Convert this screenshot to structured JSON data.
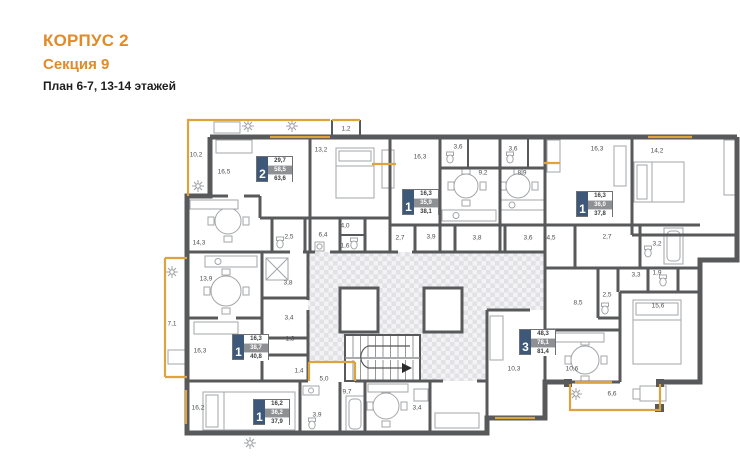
{
  "header": {
    "building": "КОРПУС 2",
    "section": "Секция 9",
    "plan": "План 6-7, 13-14 этажей"
  },
  "colors": {
    "accent_orange": "#E18B28",
    "card_number_bg": "#3D5878",
    "card_mid_bg": "#8E9093",
    "wall_gray": "#58595B",
    "window_orange": "#DDA43E"
  },
  "apartments": [
    {
      "rooms": "2",
      "living_area": "29,7",
      "area_no_balcony": "58,5",
      "total_area": "63,6"
    },
    {
      "rooms": "1",
      "living_area": "16,3",
      "area_no_balcony": "35,9",
      "total_area": "38,1"
    },
    {
      "rooms": "1",
      "living_area": "16,3",
      "area_no_balcony": "36,0",
      "total_area": "37,8"
    },
    {
      "rooms": "1",
      "living_area": "16,3",
      "area_no_balcony": "38,7",
      "total_area": "40,8"
    },
    {
      "rooms": "1",
      "living_area": "16,2",
      "area_no_balcony": "36,2",
      "total_area": "37,9"
    },
    {
      "rooms": "3",
      "living_area": "48,3",
      "area_no_balcony": "78,1",
      "total_area": "81,4"
    }
  ],
  "room_labels": [
    {
      "t": "10,2",
      "x": 196,
      "y": 155
    },
    {
      "t": "16,5",
      "x": 224,
      "y": 172
    },
    {
      "t": "13,2",
      "x": 321,
      "y": 150
    },
    {
      "t": "1,2",
      "x": 346,
      "y": 129
    },
    {
      "t": "16,3",
      "x": 420,
      "y": 157
    },
    {
      "t": "3,6",
      "x": 458,
      "y": 147
    },
    {
      "t": "3,6",
      "x": 513,
      "y": 149
    },
    {
      "t": "9,2",
      "x": 483,
      "y": 173
    },
    {
      "t": "8,9",
      "x": 522,
      "y": 173
    },
    {
      "t": "16,3",
      "x": 597,
      "y": 149
    },
    {
      "t": "14,2",
      "x": 657,
      "y": 151
    },
    {
      "t": "14,3",
      "x": 199,
      "y": 243
    },
    {
      "t": "2,5",
      "x": 289,
      "y": 237
    },
    {
      "t": "6,4",
      "x": 323,
      "y": 235
    },
    {
      "t": "4,0",
      "x": 345,
      "y": 226
    },
    {
      "t": "1,6",
      "x": 345,
      "y": 246
    },
    {
      "t": "2,7",
      "x": 400,
      "y": 238
    },
    {
      "t": "3,9",
      "x": 431,
      "y": 237
    },
    {
      "t": "3,8",
      "x": 477,
      "y": 238
    },
    {
      "t": "3,6",
      "x": 528,
      "y": 238
    },
    {
      "t": "4,5",
      "x": 551,
      "y": 238
    },
    {
      "t": "2,7",
      "x": 607,
      "y": 237
    },
    {
      "t": "3,2",
      "x": 657,
      "y": 244
    },
    {
      "t": "3,3",
      "x": 636,
      "y": 275
    },
    {
      "t": "1,9",
      "x": 657,
      "y": 273
    },
    {
      "t": "13,9",
      "x": 206,
      "y": 279
    },
    {
      "t": "7,1",
      "x": 172,
      "y": 324
    },
    {
      "t": "16,3",
      "x": 200,
      "y": 351
    },
    {
      "t": "3,8",
      "x": 288,
      "y": 283
    },
    {
      "t": "3,4",
      "x": 289,
      "y": 318
    },
    {
      "t": "1,3",
      "x": 290,
      "y": 339
    },
    {
      "t": "1,4",
      "x": 299,
      "y": 371
    },
    {
      "t": "5,0",
      "x": 324,
      "y": 379
    },
    {
      "t": "8,5",
      "x": 578,
      "y": 303
    },
    {
      "t": "2,5",
      "x": 607,
      "y": 295
    },
    {
      "t": "15,6",
      "x": 658,
      "y": 306
    },
    {
      "t": "10,3",
      "x": 514,
      "y": 369
    },
    {
      "t": "10,6",
      "x": 572,
      "y": 369
    },
    {
      "t": "6,6",
      "x": 612,
      "y": 394
    },
    {
      "t": "16,2",
      "x": 198,
      "y": 408
    },
    {
      "t": "3,9",
      "x": 317,
      "y": 415
    },
    {
      "t": "9,7",
      "x": 347,
      "y": 392
    },
    {
      "t": "3,4",
      "x": 417,
      "y": 408
    }
  ]
}
